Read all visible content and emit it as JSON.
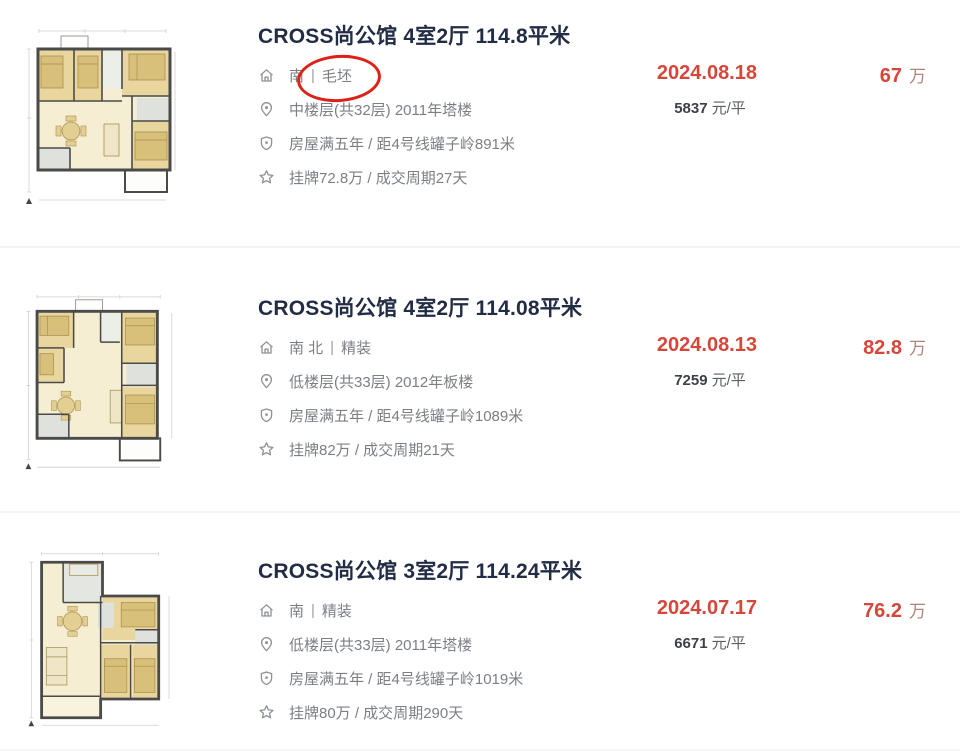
{
  "page": {
    "separator": "|",
    "wan_label": "万",
    "per_sqm_label": "元/平"
  },
  "colors": {
    "accent_red": "#d8463a",
    "title_navy": "#222c45",
    "muted_wan": "#b0837b",
    "annotation_red": "#dd2217"
  },
  "annotation": {
    "shape": "red-ellipse",
    "target": "listing 1 decoration text"
  },
  "listings": [
    {
      "title": "CROSS尚公馆 4室2厅 114.8平米",
      "orientation": "南",
      "decoration": "毛坯",
      "floor_info": "中楼层(共32层) 2011年塔楼",
      "tax_metro_info": "房屋满五年 / 距4号线罐子岭891米",
      "listing_cycle_info": "挂牌72.8万 / 成交周期27天",
      "deal_date": "2024.08.18",
      "total_price": "67",
      "unit_price": "5837"
    },
    {
      "title": "CROSS尚公馆 4室2厅 114.08平米",
      "orientation": "南 北",
      "decoration": "精装",
      "floor_info": "低楼层(共33层) 2012年板楼",
      "tax_metro_info": "房屋满五年 / 距4号线罐子岭1089米",
      "listing_cycle_info": "挂牌82万 / 成交周期21天",
      "deal_date": "2024.08.13",
      "total_price": "82.8",
      "unit_price": "7259"
    },
    {
      "title": "CROSS尚公馆 3室2厅 114.24平米",
      "orientation": "南",
      "decoration": "精装",
      "floor_info": "低楼层(共33层) 2011年塔楼",
      "tax_metro_info": "房屋满五年 / 距4号线罐子岭1019米",
      "listing_cycle_info": "挂牌80万 / 成交周期290天",
      "deal_date": "2024.07.17",
      "total_price": "76.2",
      "unit_price": "6671"
    }
  ]
}
